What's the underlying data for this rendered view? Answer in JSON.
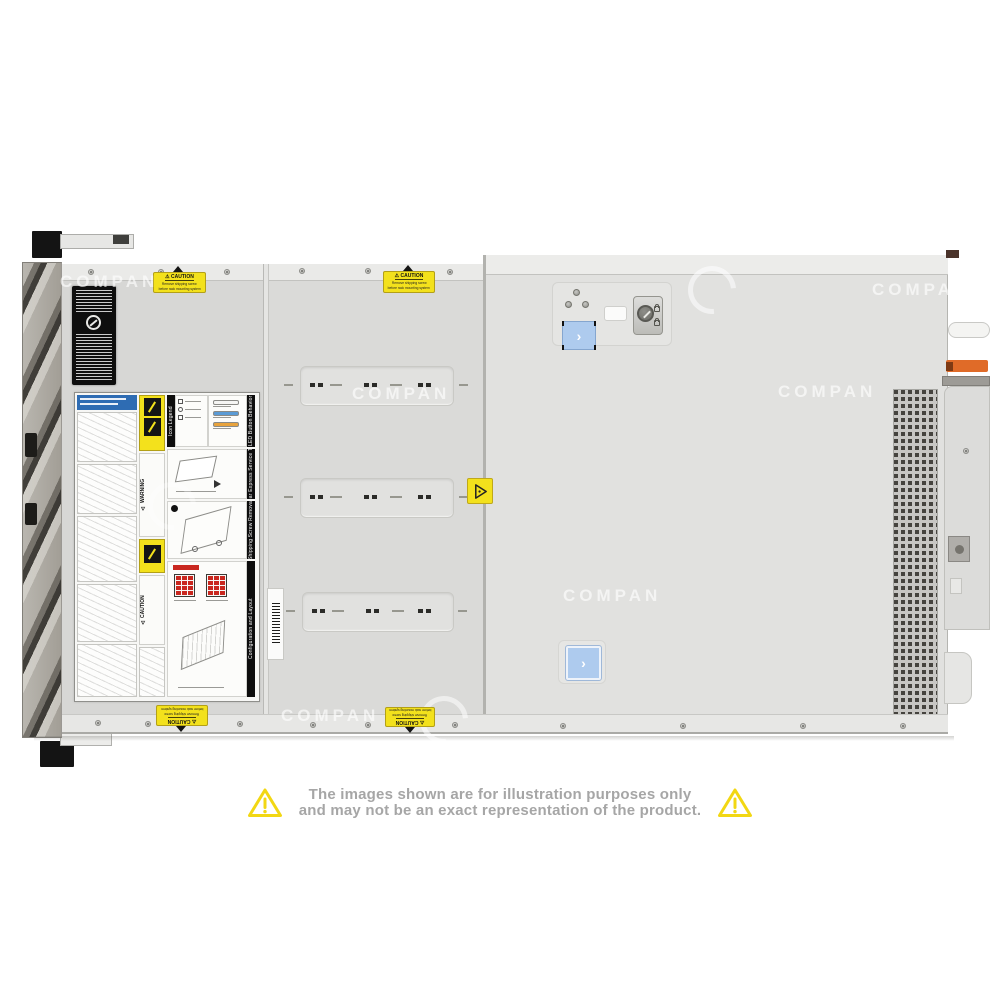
{
  "product_photo": {
    "subject": "rack server top view",
    "watermark_text": "COMPAN",
    "latch_chevron": "›"
  },
  "caution_sticker": {
    "icon": "⚠",
    "title": "CAUTION",
    "line1": "Remove shipping screw",
    "line2": "before rack mounting system"
  },
  "service_label": {
    "warning_icon": "⚠",
    "warning_title": "WARNING",
    "caution_title": "CAUTION",
    "section_titles": [
      "Icon Legend",
      "LED Button Behavior",
      "Rear Express Service Tag",
      "Shipping Screw Removal",
      "Configuration and Layout"
    ]
  },
  "disclaimer": {
    "line1": "The images shown are for illustration purposes only",
    "line2": "and may not be an exact representation of the product."
  },
  "colors": {
    "caution_yellow": "#f3e11c",
    "latch_blue": "#aecbee",
    "lever_orange": "#e06b28",
    "led_blue": "#5b9bd5",
    "led_amber": "#e8a33d",
    "drive_bay_red": "#c9271f",
    "disclaimer_triangle_yellow": "#f2d713",
    "disclaimer_text_gray": "#a6a6a6"
  }
}
